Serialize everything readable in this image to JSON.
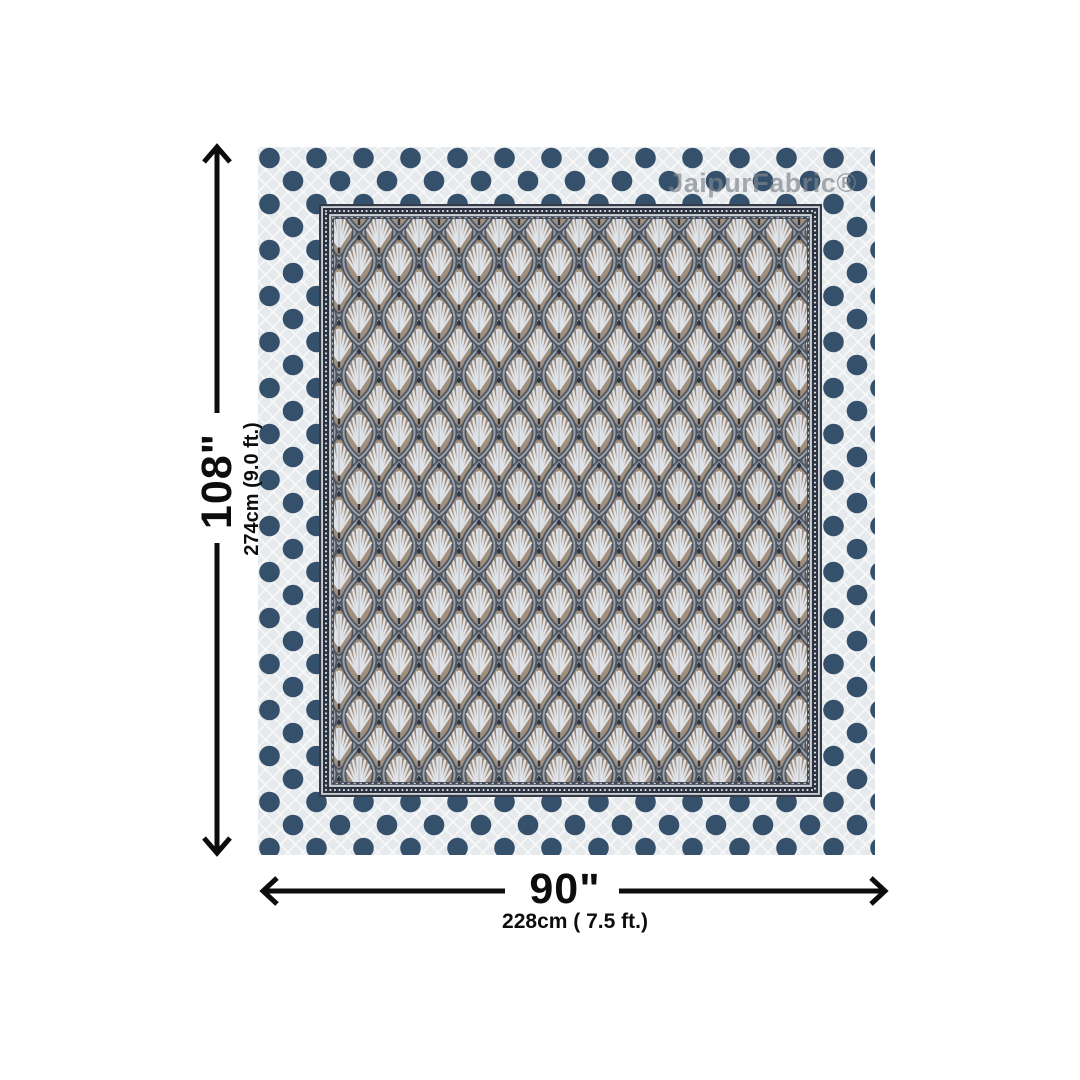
{
  "watermark": "JaipurFabric®",
  "dimensions": {
    "height": {
      "inches": "108\"",
      "metric": "274cm (9.0 ft.)"
    },
    "width": {
      "inches": "90\"",
      "metric": "228cm ( 7.5 ft.)"
    }
  },
  "icons": {
    "height_arrow": "double-headed-vertical-arrow",
    "width_arrow": "double-headed-horizontal-arrow"
  },
  "colors": {
    "dot": "#2e4a66",
    "sheet_bg": "#e7eaed",
    "panel_field": "#97a0a9",
    "panel_taupe": "#a2907e",
    "leaf_light": "#dfe3e7",
    "border_navy": "#2b3240",
    "arrow": "#0d0d0d",
    "label": "#0d0d0d",
    "watermark": "#7e858c"
  }
}
